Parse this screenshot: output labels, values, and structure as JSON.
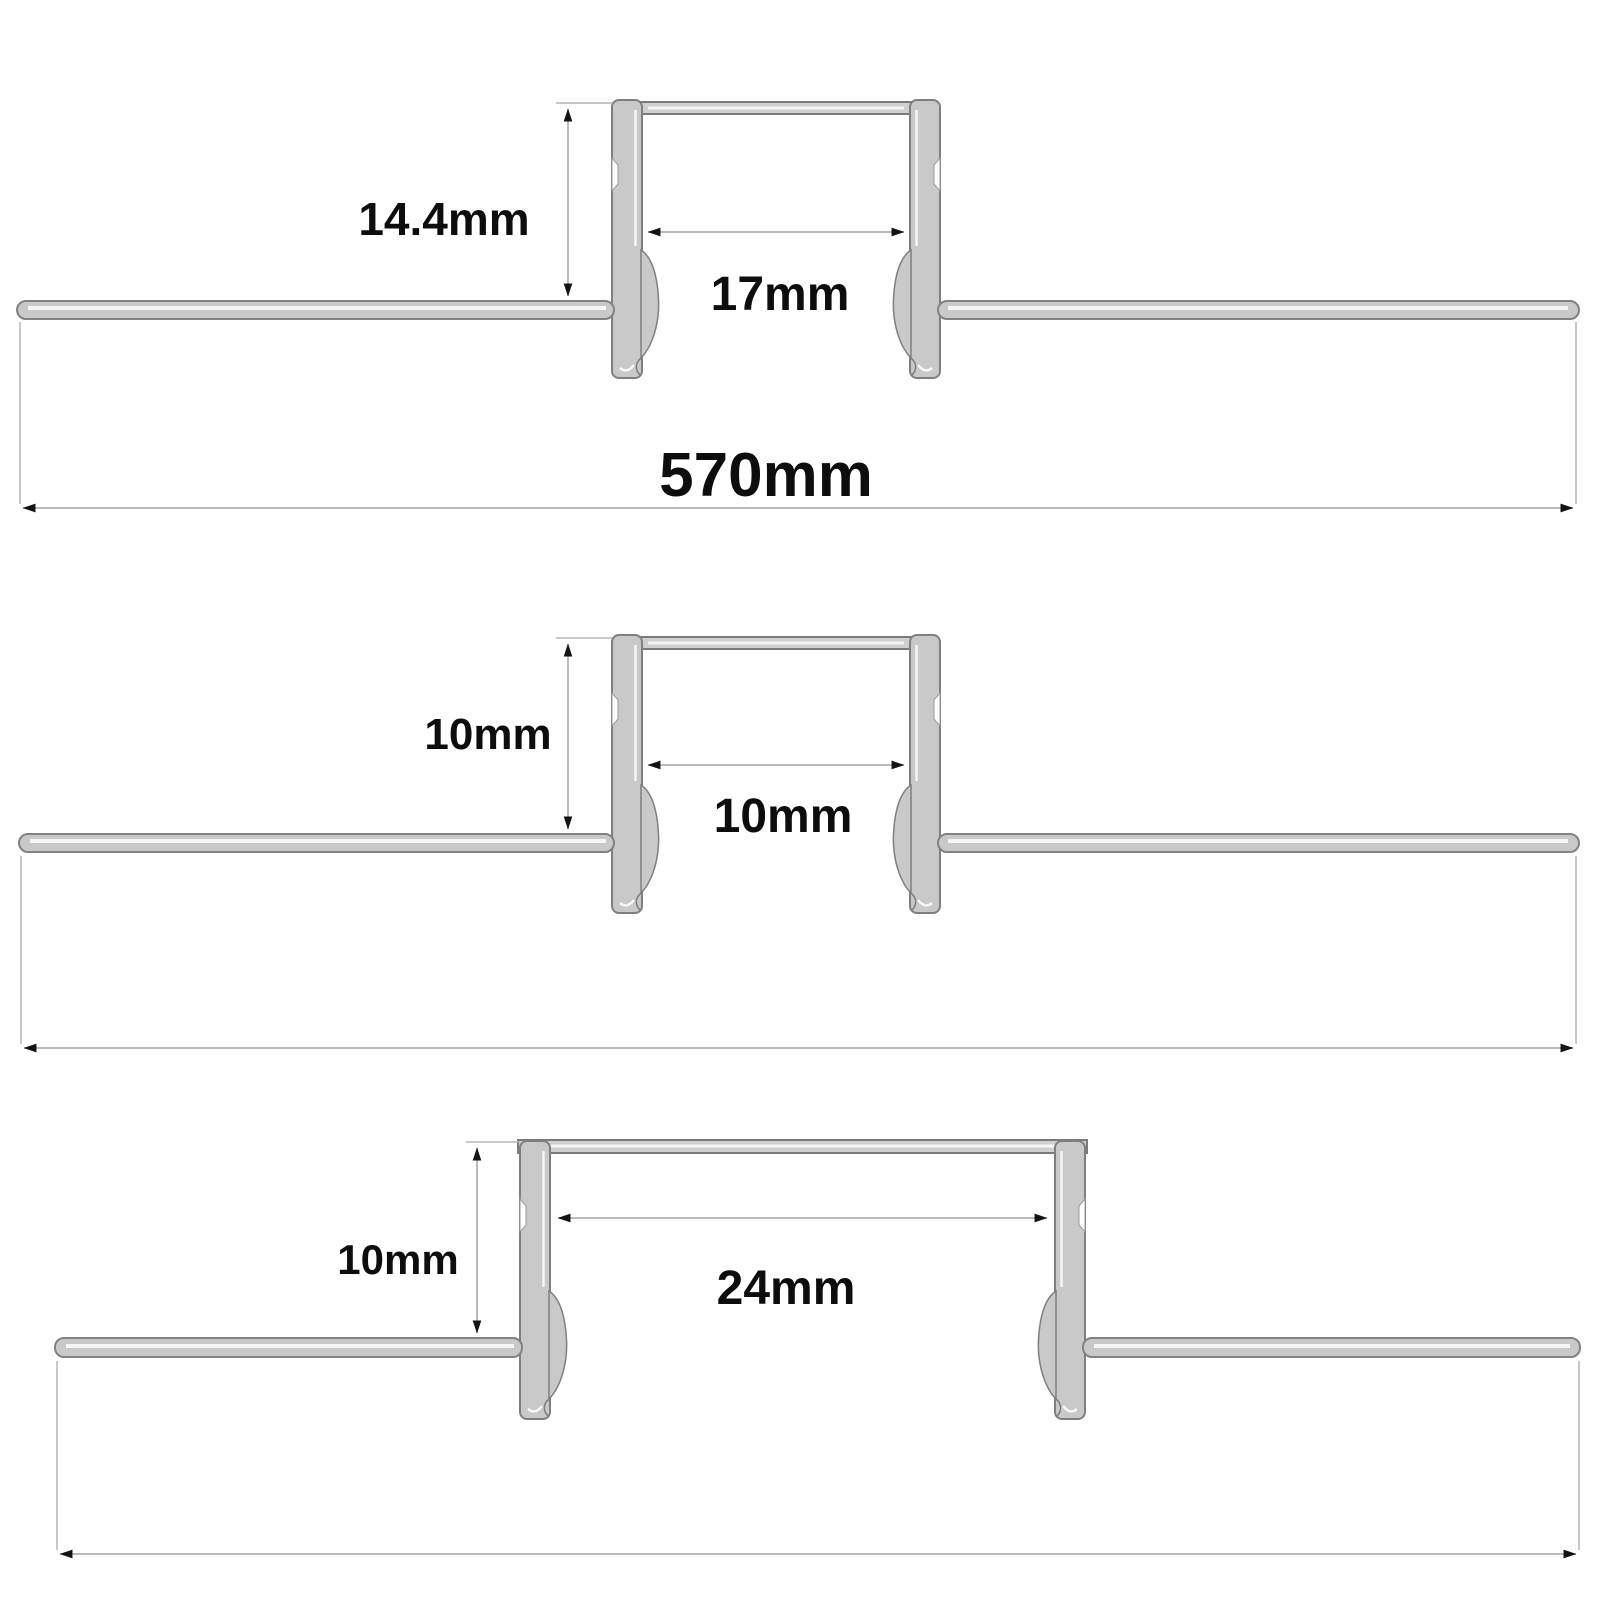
{
  "drawing": {
    "description": "Three cross-section diagrams of recessed plaster-in LED aluminium profiles with dimension annotations",
    "background": "#ffffff",
    "colors": {
      "metal_fill": "#c9c9c9",
      "metal_edge": "#7f7f7f",
      "metal_highlight": "#ffffff",
      "dimension_line": "#a3a3a3",
      "arrowhead": "#141414",
      "label_text": "#0d0d0d"
    },
    "diagrams": [
      {
        "name": "top-profile-cross-section",
        "height_label": "14.4mm",
        "inner_width_label": "17mm",
        "overall_width_label": "570mm"
      },
      {
        "name": "middle-profile-cross-section",
        "height_label": "10mm",
        "inner_width_label": "10mm"
      },
      {
        "name": "bottom-profile-cross-section",
        "height_label": "10mm",
        "inner_width_label": "24mm"
      }
    ]
  }
}
